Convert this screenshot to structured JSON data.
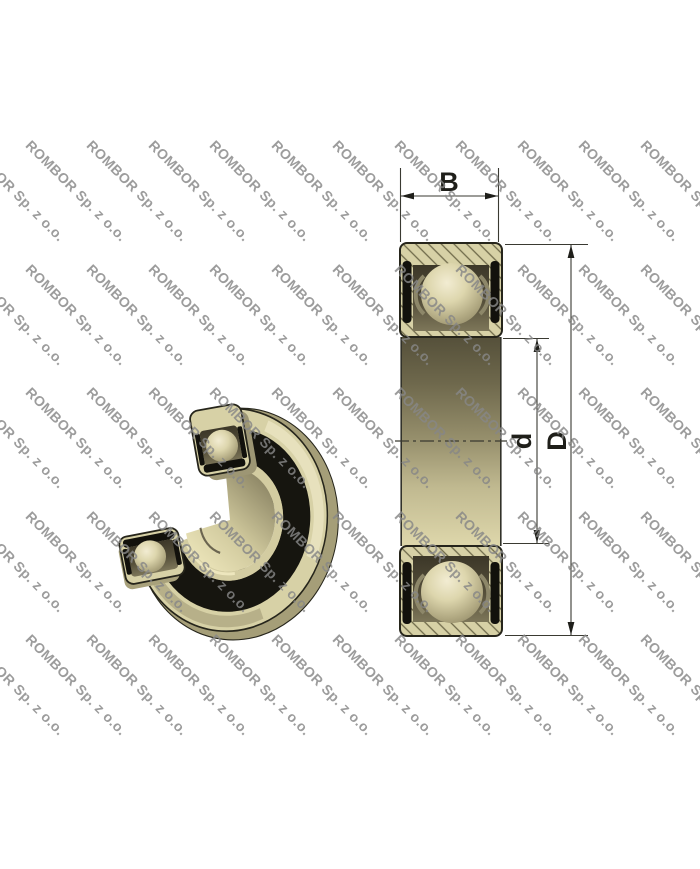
{
  "watermark": {
    "text": "ROMBOR Sp. z o.o."
  },
  "dimensions": {
    "width_label": "B",
    "bore_diameter_label": "d",
    "outer_diameter_label": "D"
  },
  "colors": {
    "background": "#ffffff",
    "watermark_gray": "#878787",
    "bearing_beige": "#d7d1a6",
    "bearing_beige_shadow": "#a59e78",
    "seal_black": "#12110c",
    "pocket_olive": "#4a4432",
    "hatch_line_olive": "#6f6a4a",
    "outline_dark": "#26251b",
    "dimension_line": "#3a3a32"
  }
}
